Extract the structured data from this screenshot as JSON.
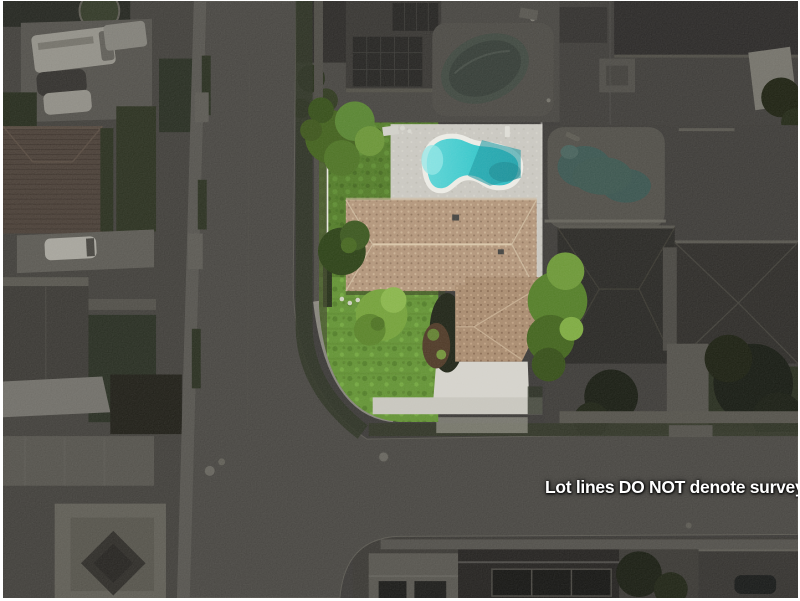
{
  "overlay": {
    "disclaimer": "Lot lines DO NOT denote survey"
  },
  "colors": {
    "frame": "#ffffff",
    "disclaimer_text": "#ffffff",
    "pool_water": "#2fc5c9",
    "pool_steps": "#8fe5e5",
    "highlight_lawn_back": "#4c7721",
    "highlight_lawn_front": "#5d8f2d",
    "concrete_deck": "#c8c6bf",
    "driveway": "#d3d1ca",
    "roof_main_tan": "#b09276",
    "roof_wing_tan": "#a6876a",
    "lot_line_white": "#eeede7",
    "asphalt": "#413f3b",
    "dark_overlay_base": "#343230",
    "neighbor_pool_teal": "#34504b"
  }
}
